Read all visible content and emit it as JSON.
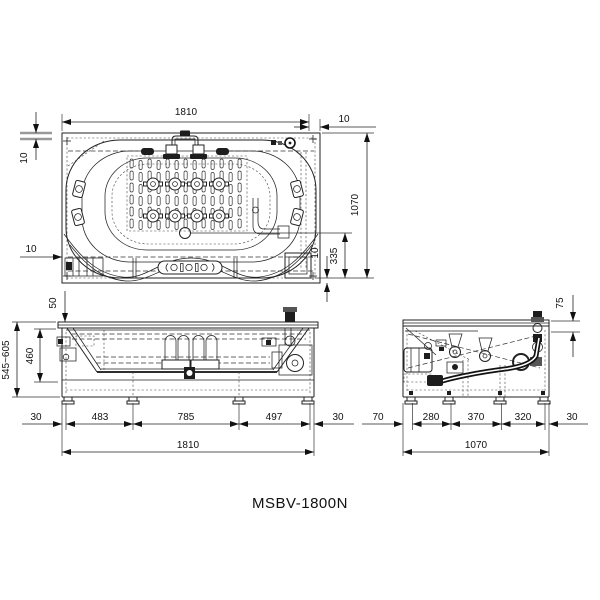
{
  "title": "MSBV-1800N",
  "plan": {
    "width": "1810",
    "top_right_gap": "10",
    "top_left_gap": "10",
    "height": "1070",
    "drain_offset": "335",
    "bottom_right_gap": "10",
    "bottom_left_gap": "10"
  },
  "front": {
    "rim_drop": "50",
    "overall_height": "545~605",
    "inner_depth": "460",
    "bottom": [
      "30",
      "483",
      "785",
      "497",
      "30"
    ],
    "total": "1810"
  },
  "side": {
    "deck_gap": "75",
    "bottom": [
      "70",
      "280",
      "370",
      "320",
      "30"
    ],
    "total": "1070"
  }
}
